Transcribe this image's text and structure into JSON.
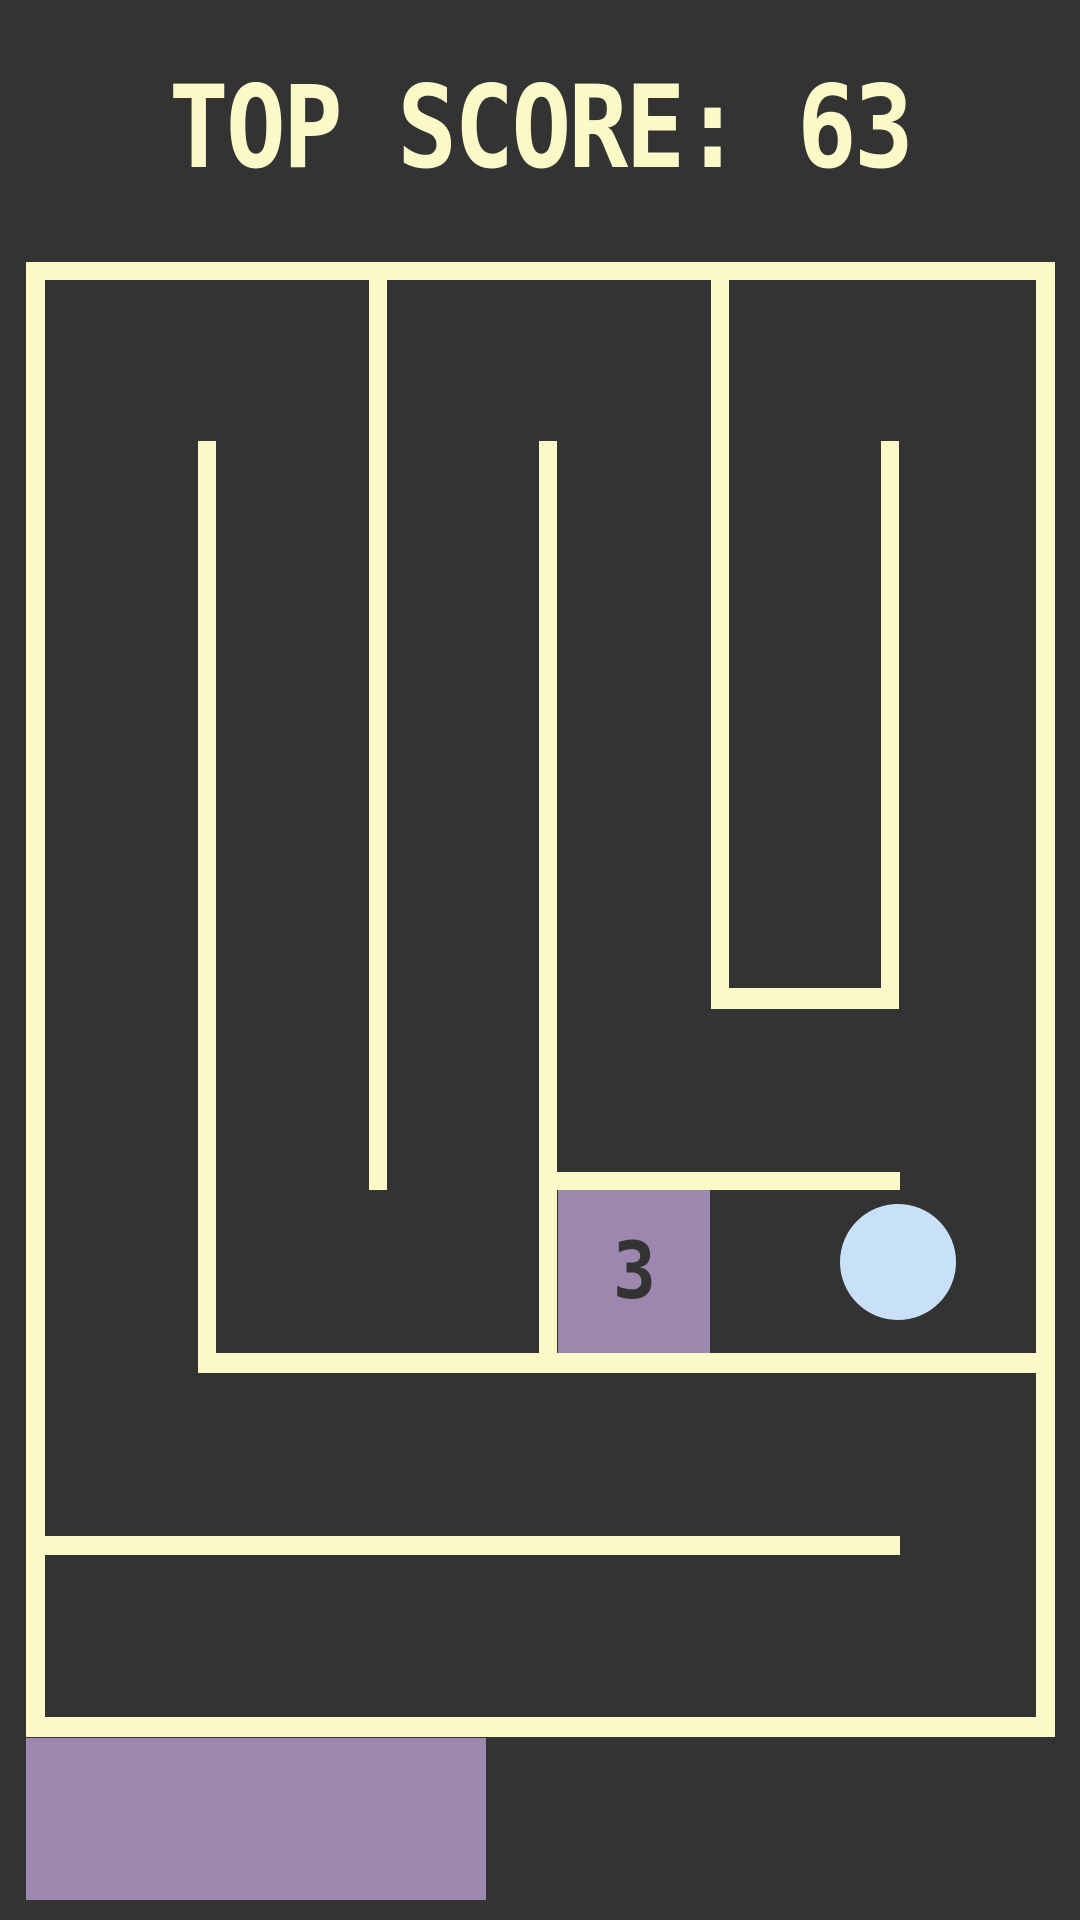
{
  "header": {
    "top_score_label": "TOP SCORE: 63",
    "top_score_value": "63"
  },
  "colors": {
    "background": "#333333",
    "wall": "#FCF9C8",
    "purple": "#9E87AE",
    "ball": "#C8E1F9",
    "digit": "#333333",
    "title_text": "#FCF9C8"
  },
  "game": {
    "countdown_block": {
      "number": "3",
      "x": 558,
      "y": 1190,
      "width": 152,
      "height": 163
    },
    "ball": {
      "x": 840,
      "y": 1204,
      "diameter": 116
    },
    "paddle": {
      "x": 26,
      "y": 1738,
      "width": 460,
      "height": 162
    },
    "walls": [
      {
        "name": "outer-border-top",
        "x": 26,
        "y": 262,
        "width": 1029,
        "height": 18
      },
      {
        "name": "outer-border-left",
        "x": 26,
        "y": 262,
        "width": 19,
        "height": 1475
      },
      {
        "name": "outer-border-right",
        "x": 1036,
        "y": 262,
        "width": 19,
        "height": 1475
      },
      {
        "name": "outer-border-bottom",
        "x": 26,
        "y": 1717,
        "width": 1029,
        "height": 20
      },
      {
        "name": "wall-hanging-left-vertical",
        "x": 369,
        "y": 280,
        "width": 18,
        "height": 910
      },
      {
        "name": "wall-hanging-right-vertical",
        "x": 711,
        "y": 280,
        "width": 18,
        "height": 729
      },
      {
        "name": "wall-inner-left-vertical",
        "x": 198,
        "y": 441,
        "width": 18,
        "height": 932
      },
      {
        "name": "wall-inner-middle-vertical",
        "x": 539,
        "y": 441,
        "width": 18,
        "height": 932
      },
      {
        "name": "wall-inner-right-vertical",
        "x": 881,
        "y": 441,
        "width": 18,
        "height": 568
      },
      {
        "name": "wall-chicane-horizontal",
        "x": 711,
        "y": 988,
        "width": 188,
        "height": 21
      },
      {
        "name": "wall-block-top-horizontal",
        "x": 539,
        "y": 1172,
        "width": 361,
        "height": 18
      },
      {
        "name": "wall-lower-horizontal-1",
        "x": 198,
        "y": 1353,
        "width": 838,
        "height": 20
      },
      {
        "name": "wall-lower-horizontal-2",
        "x": 26,
        "y": 1536,
        "width": 874,
        "height": 19
      }
    ]
  }
}
